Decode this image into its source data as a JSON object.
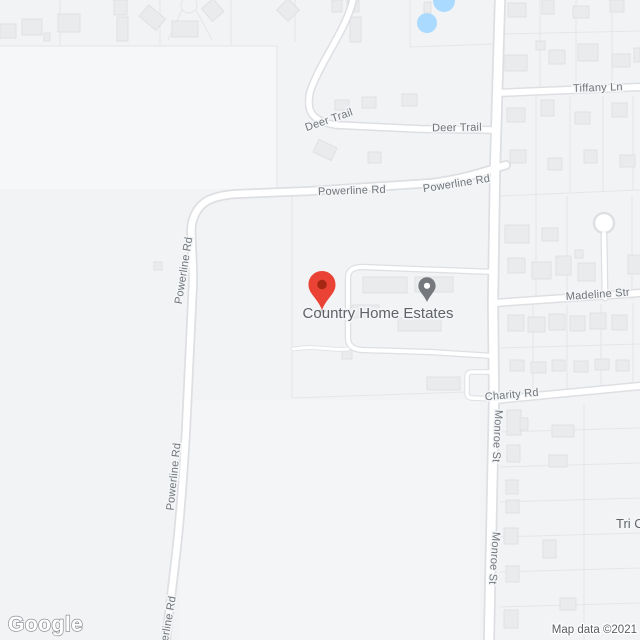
{
  "map": {
    "provider_logo": "Google",
    "attribution": "Map data ©2021",
    "place_labels": {
      "country_home_estates": "Country Home Estates",
      "tri_c": "Tri C"
    },
    "road_labels": {
      "deer_trail_a": "Deer Trail",
      "deer_trail_b": "Deer Trail",
      "powerline_h_a": "Powerline Rd",
      "powerline_h_b": "Powerline Rd",
      "powerline_v_a": "Powerline Rd",
      "powerline_v_b": "Powerline Rd",
      "powerline_v_c": "Powerline Rd",
      "tiffany_ln": "Tiffany Ln",
      "madeline_st": "Madeline Str",
      "charity_rd": "Charity Rd",
      "monroe_st_a": "Monroe St",
      "monroe_st_b": "Monroe St"
    },
    "markers": {
      "destination_pin": {
        "type": "red-map-pin",
        "color": "#EA4335",
        "inner_color": "#A52714"
      },
      "lodging_pin": {
        "type": "gray-poi-pin",
        "color": "#75797d",
        "inner_color": "#FFFFFF"
      }
    },
    "colors": {
      "background": "#F2F3F4",
      "road_fill": "#FFFFFF",
      "road_casing": "#DDDFE2",
      "building_fill": "#E9EBED",
      "parcel_line": "#E4E6E9",
      "water": "#AADAFF",
      "road_label_text": "#70757A",
      "place_label_text": "#5F6368"
    }
  }
}
